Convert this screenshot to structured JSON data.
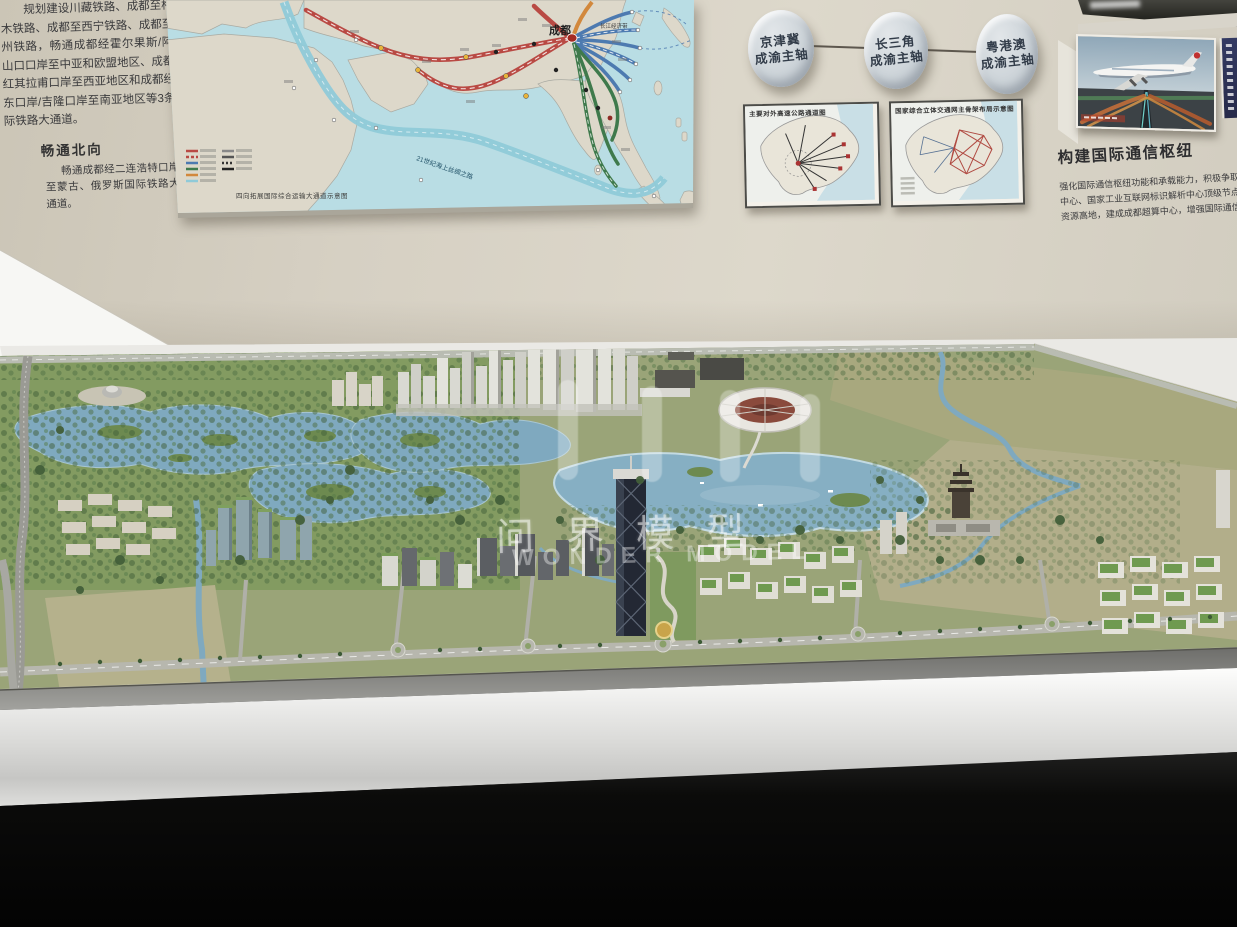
{
  "wall_panel": {
    "intro_paragraph": "规划建设川藏铁路、成都至格尔木铁路、成都至西宁铁路、成都至兰州铁路，畅通成都经霍尔果斯/阿拉山口口岸至中亚和欧盟地区、成都经红其拉甫口岸至西亚地区和成都经亚东口岸/吉隆口岸至南亚地区等3条国际铁路大通道。",
    "section_heading": "畅通北向",
    "section_paragraph": "畅通成都经二连浩特口岸至蒙古、俄罗斯国际铁路大通道。"
  },
  "route_map": {
    "hub_label": "成都",
    "corridor_label": "长江经济带",
    "sea_route_label": "21世纪海上丝绸之路",
    "caption": "四向拓展国际综合运输大通道示意图"
  },
  "axis_discs": [
    {
      "region": "京津冀",
      "axis": "成渝主轴"
    },
    {
      "region": "长三角",
      "axis": "成渝主轴"
    },
    {
      "region": "粤港澳",
      "axis": "成渝主轴"
    }
  ],
  "framed_maps": [
    {
      "title": "主要对外高速公路通道图"
    },
    {
      "title": "国家综合立体交通网主骨架布局示意图"
    }
  ],
  "comm_panel": {
    "title": "构建国际通信枢纽",
    "body_line1": "强化国际通信枢纽功能和承载能力，积极争取布局国家新型互联网交",
    "body_line2": "中心、国家工业互联网标识解析中心顶级节点等国家级通信基础设施，打",
    "body_line3": "资源高地，建成成都超算中心，增强国际通信枢纽功能。"
  },
  "model_watermark": {
    "cn": "问界模型",
    "en": "WONDER MODEL"
  },
  "colors": {
    "wall": "#d6d0c3",
    "map_ocean": "#b9dde4",
    "map_land": "#ddd8ca",
    "route_red": "#b94a44",
    "route_blue": "#4d7ab0",
    "route_green": "#3f7a4c",
    "disc_face": "#ccd3d8",
    "model_water": "#7fa9bf",
    "model_green": "#7d9a62",
    "model_field": "#b2ae8a",
    "table_white": "#f0efed"
  }
}
